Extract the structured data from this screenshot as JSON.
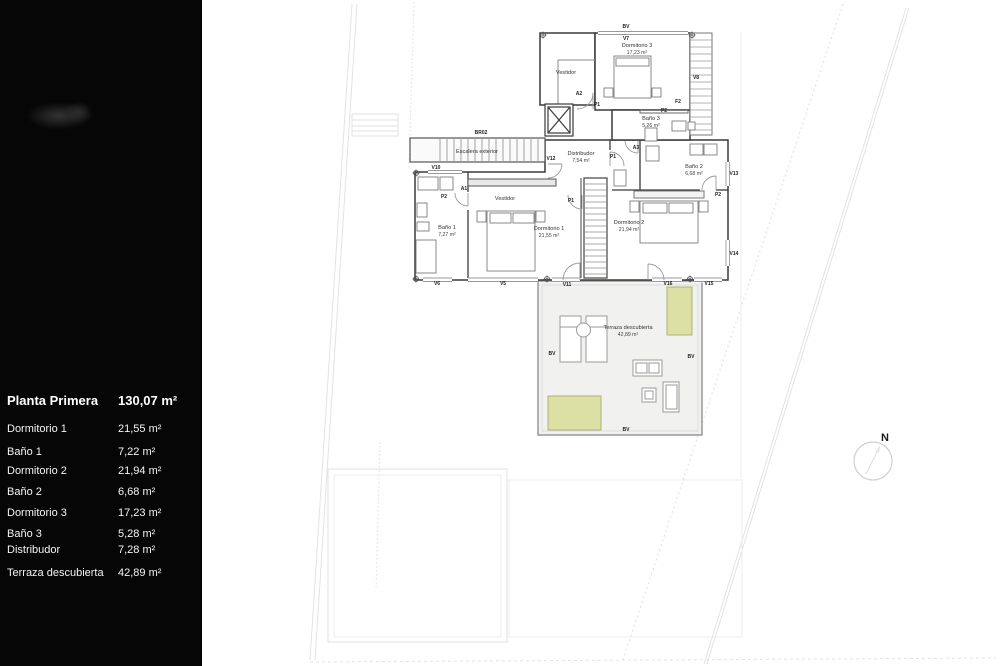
{
  "sidebar": {
    "title": {
      "label": "Planta Primera",
      "value": "130,07 m²"
    },
    "rows": [
      {
        "label": "Dormitorio 1",
        "value": "21,55 m²"
      },
      {
        "label": "Baño 1",
        "value": "7,22 m²"
      },
      {
        "label": "Dormitorio 2",
        "value": "21,94 m²"
      },
      {
        "label": "Baño 2",
        "value": "6,68 m²"
      },
      {
        "label": "Dormitorio 3",
        "value": "17,23 m²"
      },
      {
        "label": "Baño 3",
        "value": "5,28 m²"
      },
      {
        "label": "Distribudor",
        "value": "7,28 m²"
      },
      {
        "label": "Terraza descubierta",
        "value": "42,89 m²"
      }
    ]
  },
  "plan": {
    "rooms": [
      {
        "name": "Dormitorio 3",
        "area": "17,23 m²"
      },
      {
        "name": "Vestidor",
        "area": ""
      },
      {
        "name": "Baño 3",
        "area": "5,26 m²"
      },
      {
        "name": "Distribudor",
        "area": "7,54 m²"
      },
      {
        "name": "Escalera exterior",
        "area": ""
      },
      {
        "name": "Baño 1",
        "area": "7,27 m²"
      },
      {
        "name": "Vestidor",
        "area": ""
      },
      {
        "name": "Dormitorio 1",
        "area": "21,55 m²"
      },
      {
        "name": "Dormitorio 2",
        "area": "21,94 m²"
      },
      {
        "name": "Baño 2",
        "area": "6,68 m²"
      },
      {
        "name": "Terraza descubierta",
        "area": "42,89 m²"
      }
    ],
    "tags": [
      "BV",
      "V7",
      "BR02",
      "V12",
      "V10",
      "A1",
      "A2",
      "P1",
      "F2",
      "P2",
      "A3",
      "P1",
      "P1",
      "P2",
      "P2",
      "V8",
      "V13",
      "V14",
      "V6",
      "V5",
      "V11",
      "V16",
      "V15",
      "BV",
      "BV",
      "BV"
    ],
    "compass": {
      "label": "N"
    }
  },
  "colors": {
    "sidebar_bg": "#060606",
    "wall": "#3a3a3a",
    "terrace_fill": "#f1f1f0",
    "planter_fill": "#dce0a5",
    "faint_line": "#e3e3e3"
  }
}
